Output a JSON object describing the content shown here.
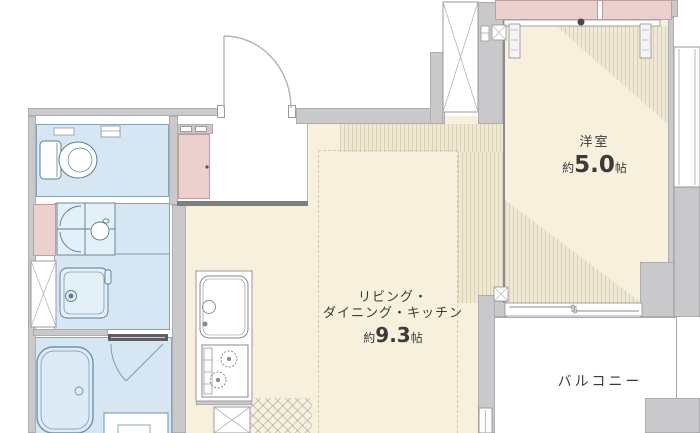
{
  "plan_title": "apartment-floor-plan",
  "rooms": {
    "western": {
      "name": "洋室",
      "approx": "約",
      "area": "5.0",
      "unit": "帖"
    },
    "ldk": {
      "line1": "リビング・",
      "line2": "ダイニング・キッチン",
      "approx": "約",
      "area": "9.3",
      "unit": "帖"
    },
    "balcony": {
      "name": "バルコニー"
    }
  },
  "colors": {
    "wall_gray": "#c9c9cb",
    "room_cream": "#f6f0dd",
    "stripe_base": "#efe8d2",
    "stripe_line": "#d9d1b6",
    "wet_area_blue": "#d6e7f3",
    "wet_line_blue": "#86a7bb",
    "closet_pink": "#ecd0cd",
    "outline_gray": "#9a9a9e",
    "text": "#3a3a3a"
  },
  "fixtures": [
    "entrance-door",
    "shoe-cabinet",
    "toilet",
    "washbasin-vanity",
    "washstand",
    "washing-machine-space",
    "bathtub",
    "bath-door",
    "bath-counter",
    "kitchen-sink",
    "stove",
    "refrigerator-space",
    "meter-box",
    "closet",
    "closet-sliding-track",
    "sliding-window-balcony",
    "window-right",
    "balcony-access-window",
    "column-marker"
  ]
}
